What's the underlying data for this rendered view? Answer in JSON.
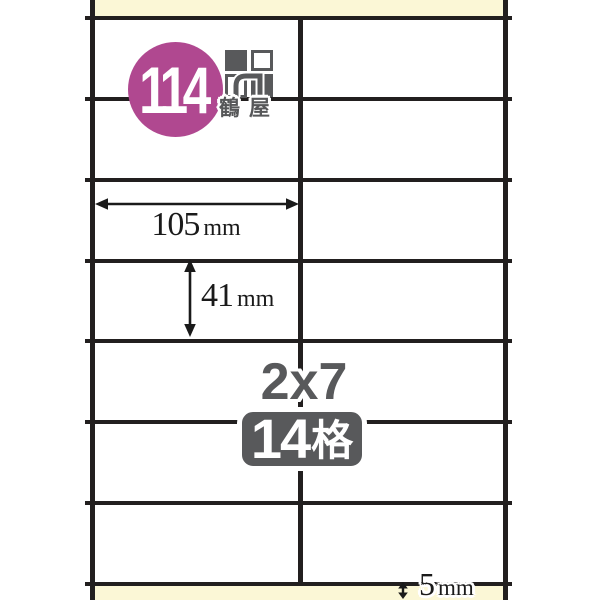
{
  "product": {
    "code": "114",
    "brand": "鶴屋",
    "layout": "2x7",
    "count_value": "14",
    "count_unit": "格",
    "grid": {
      "columns": 2,
      "rows": 7
    }
  },
  "dimensions": {
    "label_width": {
      "value": "105",
      "unit": "mm"
    },
    "label_height": {
      "value": "41",
      "unit": "mm"
    },
    "bottom_margin": {
      "value": "5",
      "unit": "mm"
    }
  },
  "icons": {
    "brand_logo": "herwood-squares-logo-icon",
    "width_arrow": "horizontal-double-arrow-icon",
    "height_arrow": "vertical-double-arrow-icon",
    "bottom_margin_arrow": "small-vertical-double-arrow-icon"
  },
  "colors": {
    "page_background": "#ffffff",
    "sheet_margin_cream": "#fbf7d6",
    "grid_line_black": "#221f1f",
    "code_circle_magenta": "#b04890",
    "brand_gray": "#58595b",
    "dimension_text": "#1a1a1a"
  }
}
